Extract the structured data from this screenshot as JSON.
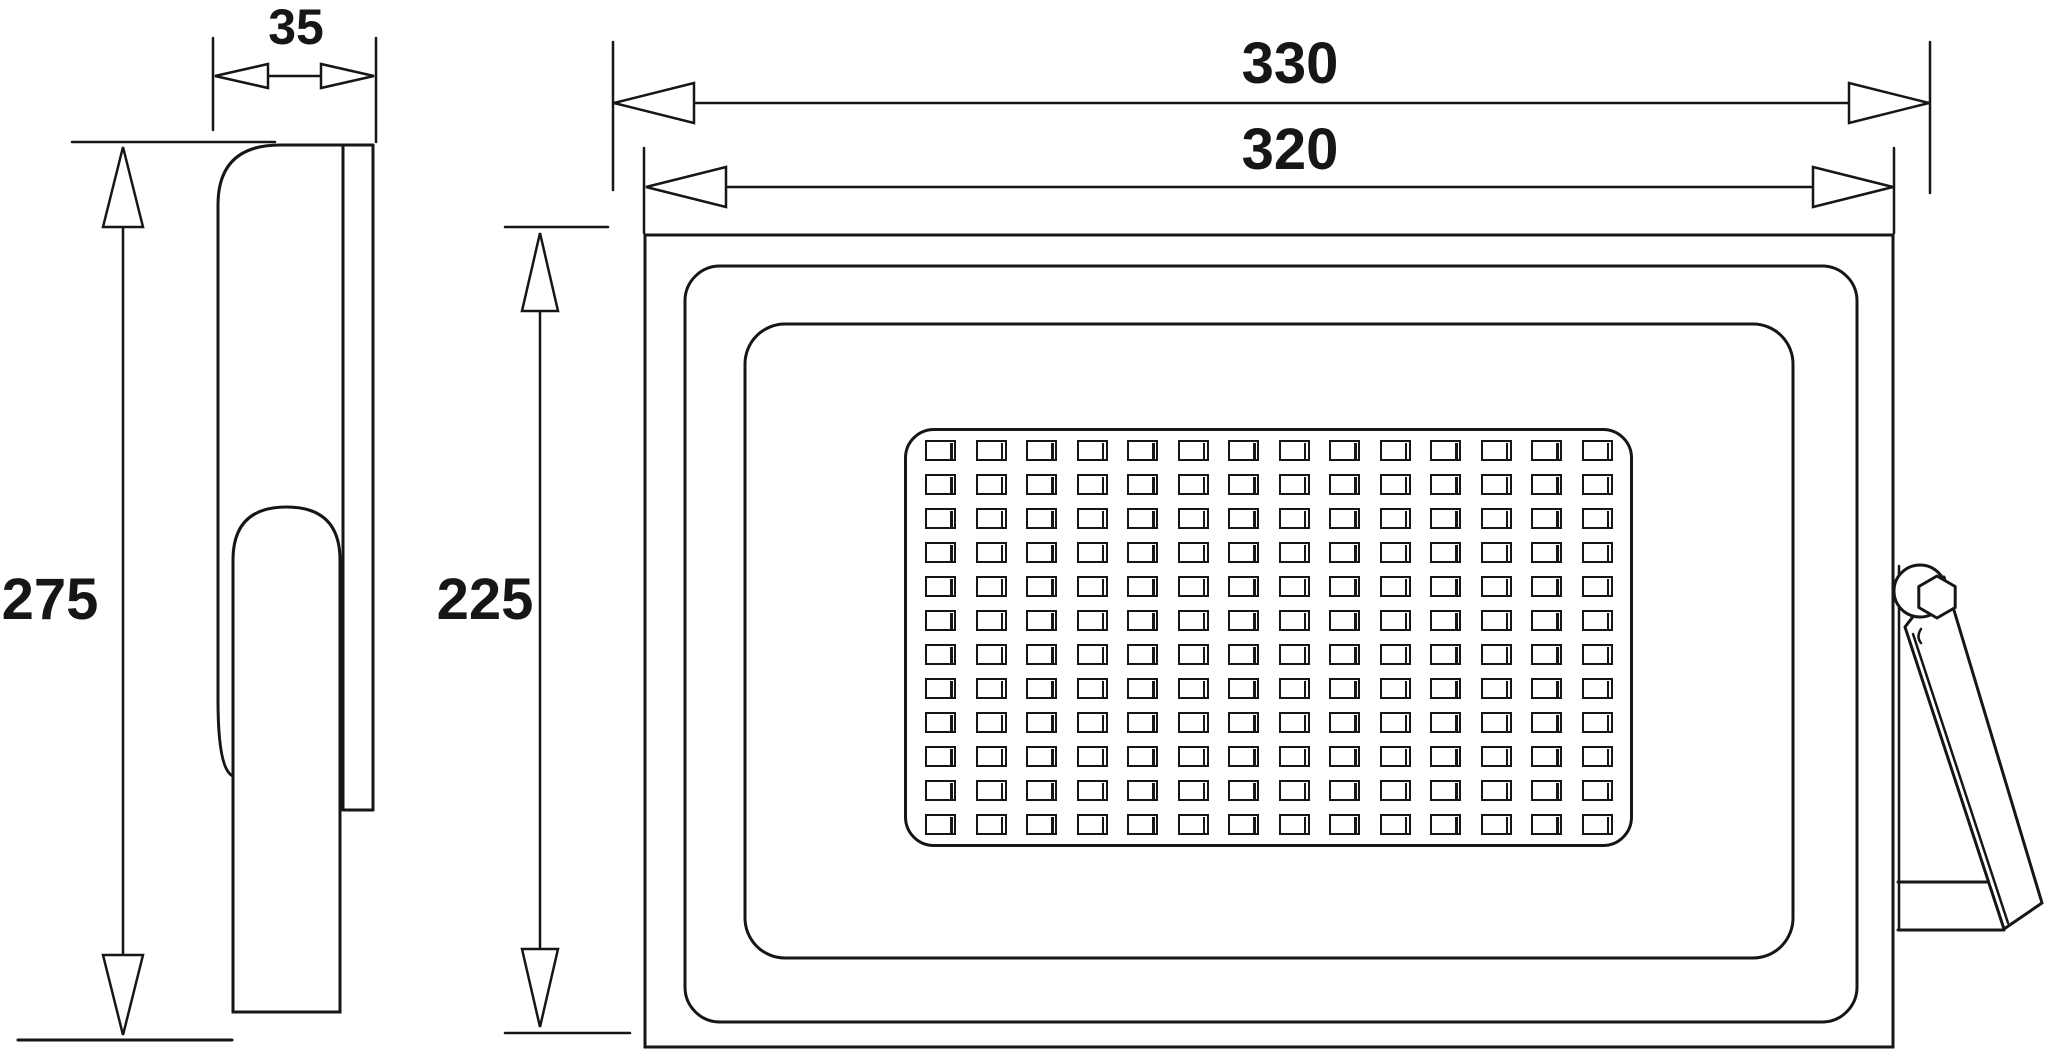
{
  "drawing": {
    "title": "floodlight-dimensional-drawing",
    "labels": {
      "depth": "35",
      "overall_width": "330",
      "body_width": "320",
      "overall_height": "275",
      "body_height": "225"
    },
    "led_grid": {
      "rows": 12,
      "cols": 14
    },
    "colors": {
      "line": "#161616",
      "background": "#ffffff"
    }
  }
}
